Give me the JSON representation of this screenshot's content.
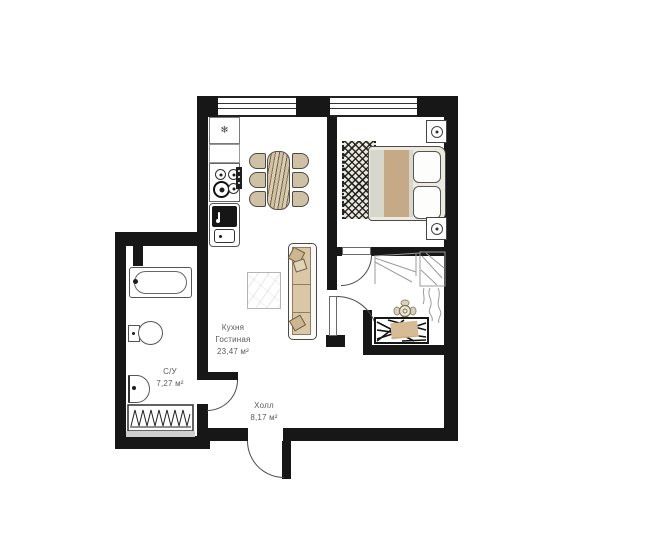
{
  "floor_plan": {
    "rooms": {
      "kitchen_living": {
        "label_line1": "Кухня",
        "label_line2": "Гостиная",
        "area": "23,47 м²"
      },
      "bathroom": {
        "label": "С/У",
        "area": "7,27 м²"
      },
      "hall": {
        "label": "Холл",
        "area": "8,17 м²"
      }
    },
    "icons": {
      "fridge_snowflake": "❄"
    },
    "colors": {
      "wall": "#171717",
      "outline": "#4a4a4a",
      "wood_beige": "#d2c3a6",
      "tan_accent": "#c7aa85",
      "label_text": "#5a5a5a",
      "background": "#ffffff"
    }
  }
}
